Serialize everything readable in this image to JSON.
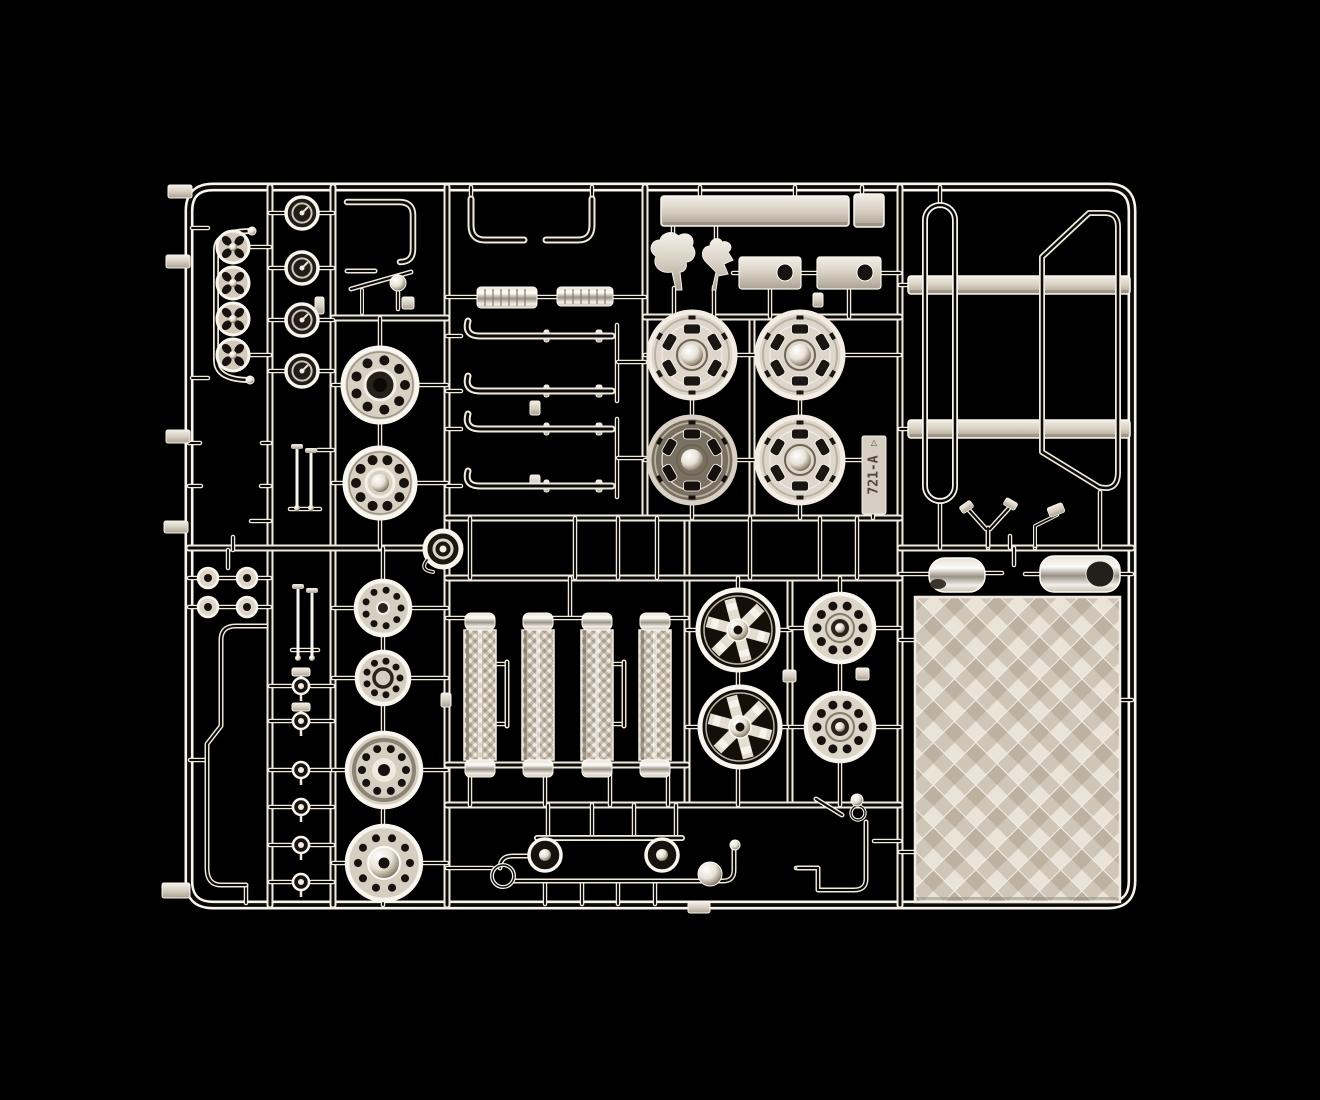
{
  "meta": {
    "title": "Chrome model kit sprue",
    "description": "Photograph of a chrome-plated plastic model kit parts sprue (runner tree) with wheels, exhaust pipes, air filters, mirrors, roll bars and a checker tread plate, on a black background",
    "tag_text": "721-A"
  },
  "palette": {
    "bg": "#000000",
    "hi": "#efe9df",
    "hi2": "#f8f5ef",
    "core": "#0d0b08",
    "plate": "#d9d1c4",
    "plate_dark": "#a89e8e",
    "dark_face": "#17120d",
    "tag_fill": "#d6cec2",
    "tag_text_color": "#4e443a"
  },
  "frame": {
    "d": "M213,187 H1108 Q1132,187 1132,211 V881 Q1132,905 1108,905 H213 Q189,905 189,881 V211 Q189,187 213,187 Z",
    "w": 9
  },
  "runners": [
    [
      270,
      187,
      270,
      905
    ],
    [
      333,
      187,
      333,
      905
    ],
    [
      447,
      187,
      447,
      905
    ],
    [
      645,
      187,
      645,
      518
    ],
    [
      687,
      518,
      687,
      805
    ],
    [
      752,
      317,
      752,
      518
    ],
    [
      790,
      578,
      790,
      805
    ],
    [
      900,
      187,
      900,
      905
    ],
    [
      189,
      548,
      447,
      548
    ],
    [
      447,
      518,
      900,
      518
    ],
    [
      447,
      578,
      900,
      578
    ],
    [
      900,
      548,
      1132,
      548
    ],
    [
      645,
      317,
      900,
      317
    ],
    [
      333,
      318,
      447,
      318
    ],
    [
      447,
      765,
      687,
      765
    ],
    [
      447,
      805,
      900,
      805
    ]
  ],
  "stubs": [
    [
      192,
      228,
      208,
      228
    ],
    [
      192,
      378,
      208,
      378
    ],
    [
      251,
      247,
      270,
      247
    ],
    [
      251,
      355,
      270,
      355
    ],
    [
      189,
      443,
      200,
      443
    ],
    [
      262,
      443,
      270,
      443
    ],
    [
      189,
      486,
      201,
      486
    ],
    [
      261,
      486,
      270,
      486
    ],
    [
      251,
      521,
      270,
      521
    ],
    [
      233,
      537,
      233,
      550
    ],
    [
      218,
      578,
      238,
      578
    ],
    [
      218,
      607,
      238,
      607
    ],
    [
      189,
      578,
      198,
      578
    ],
    [
      257,
      578,
      270,
      578
    ],
    [
      189,
      607,
      198,
      607
    ],
    [
      257,
      607,
      270,
      607
    ],
    [
      228,
      550,
      228,
      568
    ],
    [
      246,
      886,
      246,
      903
    ],
    [
      190,
      760,
      206,
      760
    ],
    [
      270,
      213,
      287,
      213
    ],
    [
      317,
      213,
      333,
      213
    ],
    [
      270,
      268,
      287,
      268
    ],
    [
      317,
      268,
      333,
      268
    ],
    [
      270,
      320,
      287,
      320
    ],
    [
      317,
      320,
      333,
      320
    ],
    [
      270,
      371,
      287,
      371
    ],
    [
      317,
      371,
      333,
      371
    ],
    [
      290,
      509,
      320,
      509
    ],
    [
      318,
      450,
      333,
      450
    ],
    [
      292,
      650,
      318,
      650
    ],
    [
      270,
      686,
      291,
      686
    ],
    [
      311,
      686,
      333,
      686
    ],
    [
      270,
      721,
      291,
      721
    ],
    [
      311,
      721,
      333,
      721
    ],
    [
      270,
      770,
      291,
      770
    ],
    [
      311,
      770,
      333,
      770
    ],
    [
      270,
      807,
      291,
      807
    ],
    [
      311,
      807,
      333,
      807
    ],
    [
      270,
      845,
      291,
      845
    ],
    [
      311,
      845,
      333,
      845
    ],
    [
      270,
      882,
      291,
      882
    ],
    [
      311,
      882,
      333,
      882
    ],
    [
      380,
      318,
      380,
      349
    ],
    [
      380,
      423,
      380,
      448
    ],
    [
      380,
      519,
      380,
      548
    ],
    [
      333,
      385,
      343,
      385
    ],
    [
      417,
      385,
      447,
      385
    ],
    [
      333,
      483,
      345,
      483
    ],
    [
      415,
      483,
      447,
      483
    ],
    [
      383,
      548,
      383,
      580
    ],
    [
      383,
      636,
      383,
      651
    ],
    [
      383,
      705,
      383,
      732
    ],
    [
      383,
      808,
      383,
      825
    ],
    [
      383,
      901,
      383,
      905
    ],
    [
      333,
      608,
      355,
      608
    ],
    [
      411,
      608,
      447,
      608
    ],
    [
      333,
      678,
      356,
      678
    ],
    [
      410,
      678,
      447,
      678
    ],
    [
      333,
      770,
      346,
      770
    ],
    [
      422,
      770,
      447,
      770
    ],
    [
      333,
      863,
      346,
      863
    ],
    [
      422,
      863,
      447,
      863
    ],
    [
      471,
      187,
      471,
      199
    ],
    [
      592,
      187,
      592,
      199
    ],
    [
      447,
      297,
      476,
      297
    ],
    [
      538,
      297,
      557,
      297
    ],
    [
      613,
      297,
      645,
      297
    ],
    [
      447,
      336,
      461,
      336
    ],
    [
      447,
      391,
      461,
      391
    ],
    [
      447,
      429,
      461,
      429
    ],
    [
      447,
      486,
      461,
      486
    ],
    [
      617,
      325,
      617,
      401
    ],
    [
      617,
      419,
      617,
      497
    ],
    [
      618,
      362,
      645,
      362
    ],
    [
      618,
      458,
      645,
      458
    ],
    [
      700,
      187,
      700,
      196
    ],
    [
      795,
      187,
      795,
      196
    ],
    [
      862,
      187,
      862,
      194
    ],
    [
      673,
      226,
      673,
      240
    ],
    [
      716,
      226,
      716,
      245
    ],
    [
      674,
      288,
      674,
      317
    ],
    [
      714,
      287,
      714,
      317
    ],
    [
      733,
      273,
      739,
      273
    ],
    [
      801,
      273,
      817,
      273
    ],
    [
      881,
      273,
      900,
      273
    ],
    [
      770,
      289,
      770,
      317
    ],
    [
      849,
      289,
      849,
      317
    ],
    [
      645,
      355,
      650,
      355
    ],
    [
      734,
      355,
      758,
      355
    ],
    [
      842,
      355,
      900,
      355
    ],
    [
      645,
      460,
      650,
      460
    ],
    [
      734,
      460,
      758,
      460
    ],
    [
      842,
      460,
      866,
      460
    ],
    [
      692,
      398,
      692,
      418
    ],
    [
      800,
      398,
      800,
      418
    ],
    [
      692,
      502,
      692,
      518
    ],
    [
      800,
      502,
      800,
      518
    ],
    [
      873,
      513,
      873,
      518
    ],
    [
      900,
      285,
      910,
      285
    ],
    [
      900,
      429,
      910,
      429
    ],
    [
      940,
      187,
      940,
      206
    ],
    [
      940,
      500,
      940,
      548
    ],
    [
      1100,
      492,
      1100,
      548
    ],
    [
      988,
      545,
      988,
      548
    ],
    [
      1035,
      545,
      1035,
      548
    ],
    [
      1010,
      536,
      1010,
      548
    ],
    [
      900,
      574,
      929,
      574
    ],
    [
      985,
      573,
      1002,
      573
    ],
    [
      1014,
      548,
      1014,
      565
    ],
    [
      1025,
      574,
      1040,
      574
    ],
    [
      1120,
      574,
      1132,
      574
    ],
    [
      900,
      640,
      915,
      640
    ],
    [
      900,
      852,
      915,
      852
    ],
    [
      1120,
      700,
      1132,
      700
    ],
    [
      470,
      518,
      470,
      578
    ],
    [
      575,
      518,
      575,
      578
    ],
    [
      618,
      518,
      618,
      578
    ],
    [
      657,
      518,
      657,
      578
    ],
    [
      750,
      518,
      750,
      578
    ],
    [
      820,
      518,
      820,
      578
    ],
    [
      857,
      518,
      857,
      578
    ],
    [
      447,
      618,
      464,
      618
    ],
    [
      671,
      618,
      687,
      618
    ],
    [
      570,
      578,
      570,
      616
    ],
    [
      538,
      618,
      597,
      618
    ],
    [
      496,
      664,
      507,
      664
    ],
    [
      496,
      724,
      507,
      724
    ],
    [
      613,
      664,
      624,
      664
    ],
    [
      613,
      724,
      624,
      724
    ],
    [
      470,
      765,
      470,
      805
    ],
    [
      545,
      765,
      545,
      805
    ],
    [
      610,
      765,
      610,
      805
    ],
    [
      668,
      765,
      668,
      805
    ],
    [
      687,
      630,
      700,
      630
    ],
    [
      776,
      630,
      790,
      630
    ],
    [
      687,
      727,
      702,
      727
    ],
    [
      778,
      727,
      790,
      727
    ],
    [
      790,
      628,
      808,
      628
    ],
    [
      872,
      628,
      900,
      628
    ],
    [
      790,
      727,
      808,
      727
    ],
    [
      872,
      727,
      900,
      727
    ],
    [
      738,
      578,
      738,
      592
    ],
    [
      840,
      578,
      840,
      596
    ],
    [
      738,
      668,
      738,
      689
    ],
    [
      840,
      660,
      840,
      695
    ],
    [
      738,
      765,
      738,
      805
    ],
    [
      840,
      759,
      840,
      805
    ],
    [
      548,
      805,
      548,
      837
    ],
    [
      592,
      805,
      592,
      837
    ],
    [
      634,
      805,
      634,
      837
    ],
    [
      676,
      805,
      676,
      837
    ],
    [
      545,
      881,
      545,
      904
    ],
    [
      582,
      881,
      582,
      904
    ],
    [
      618,
      881,
      618,
      904
    ],
    [
      655,
      881,
      655,
      904
    ],
    [
      447,
      868,
      492,
      868
    ],
    [
      874,
      841,
      900,
      841
    ],
    [
      796,
      868,
      816,
      868
    ],
    [
      398,
      291,
      398,
      309
    ]
  ],
  "tubes": [
    {
      "name": "handrail-part",
      "d": "M252,231 Q216,231 216,250 V360 Q216,380 250,380",
      "w": 6
    },
    {
      "name": "bent-pipe-part",
      "d": "M266,626 H236 Q221,626 221,640 V726 L207,744 V868 Q207,885 221,885 H246",
      "w": 5
    },
    {
      "name": "hook-pipe-part",
      "d": "M347,202 H399 Q413,202 413,215 V249 Q413,262 400,262",
      "w": 6.5
    },
    {
      "name": "short-pipe-part",
      "d": "M347,271 H375",
      "w": 5
    },
    {
      "name": "diagonal-rod-part",
      "d": "M351,289 L411,272",
      "w": 5
    },
    {
      "name": "post-part",
      "d": "M362,290 V313",
      "w": 4
    },
    {
      "name": "elbow-pipe-left",
      "d": "M471,199 V225 Q471,240 485,240 H524",
      "w": 7
    },
    {
      "name": "elbow-pipe-right",
      "d": "M592,199 V225 Q592,240 578,240 H546",
      "w": 7
    },
    {
      "name": "exhaust-pipe-1",
      "d": "M468,321 Q464,336 480,336 H612",
      "w": 7
    },
    {
      "name": "exhaust-pipe-2",
      "d": "M468,376 Q464,391 480,391 H612",
      "w": 7
    },
    {
      "name": "exhaust-pipe-3",
      "d": "M468,414 Q464,429 480,429 H612",
      "w": 7
    },
    {
      "name": "exhaust-pipe-4",
      "d": "M468,471 Q464,486 480,486 H612",
      "w": 7
    },
    {
      "name": "filter-handle-1",
      "d": "M507,662 V726",
      "w": 5
    },
    {
      "name": "filter-handle-2",
      "d": "M624,662 V726",
      "w": 5
    },
    {
      "name": "wishbone-part",
      "d": "M968,509 L986,529 M1011,506 L990,529 M988,528 V546",
      "w": 5
    },
    {
      "name": "mirror-arm-part",
      "d": "M1035,546 V526 L1057,515",
      "w": 4
    },
    {
      "name": "bracket-diagonal",
      "d": "M816,799 L842,815",
      "w": 5
    },
    {
      "name": "bracket-pipe-part",
      "d": "M866,822 V879 Q866,890 854,890 H818 V868 H798",
      "w": 5
    },
    {
      "name": "bell-bar-part",
      "d": "M537,838 H682",
      "w": 6
    },
    {
      "name": "curl-pipe-part",
      "d": "M531,856 H513 Q500,856 500,868",
      "w": 5
    },
    {
      "name": "long-low-pipe",
      "d": "M514,881 H723 Q734,881 734,870 V849",
      "w": 5
    },
    {
      "name": "hex-loop-part",
      "d": "M1042,452 V257 L1089,213 H1105 Q1118,213 1118,227 V472 Q1118,492 1099,487 Z",
      "w": 6
    }
  ],
  "loop_rect": {
    "x": 925,
    "y": 205,
    "w": 30,
    "h": 296,
    "rx": 15,
    "sw": 6
  },
  "panels": [
    {
      "name": "long-panel-part",
      "x": 661,
      "y": 196,
      "w": 188,
      "h": 30
    },
    {
      "name": "end-panel-part",
      "x": 854,
      "y": 194,
      "w": 30,
      "h": 33
    },
    {
      "name": "flat-bar-part-1",
      "x": 908,
      "y": 276,
      "w": 222,
      "h": 18
    },
    {
      "name": "flat-bar-part-2",
      "x": 908,
      "y": 420,
      "w": 222,
      "h": 18
    }
  ],
  "mufflers": [
    {
      "x": 477,
      "y": 287,
      "w": 60,
      "h": 21
    },
    {
      "x": 557,
      "y": 287,
      "w": 56,
      "h": 19
    }
  ],
  "slot_plates": [
    {
      "x": 739,
      "y": 257,
      "w": 62,
      "h": 32,
      "sx": 777,
      "sy": 264
    },
    {
      "x": 817,
      "y": 257,
      "w": 64,
      "h": 32,
      "sx": 857,
      "sy": 264
    }
  ],
  "silhouettes": [
    {
      "name": "poodle-silhouette-part",
      "d": "M676,290 L672,272 C660,274 652,266 656,256 C648,252 650,240 660,240 C662,232 674,230 678,236 C688,230 696,238 692,246 C698,252 694,262 686,262 C688,270 682,272 680,272 L682,290 Z"
    },
    {
      "name": "figure-silhouette-part",
      "d": "M712,290 L716,272 L706,262 C700,256 702,246 710,246 C710,238 720,236 722,242 C730,240 734,248 728,252 L733,260 L724,264 L728,274 L718,276 L716,290 Z"
    }
  ],
  "horns": {
    "cx": 233,
    "cys": [
      247,
      283,
      319,
      355
    ],
    "r": 16
  },
  "dials": {
    "cx": 302,
    "cys": [
      213,
      268,
      320,
      371
    ],
    "r": 16
  },
  "bulbs": [
    {
      "cx": 208,
      "cy": 578
    },
    {
      "cx": 247,
      "cy": 578
    },
    {
      "cx": 208,
      "cy": 607
    },
    {
      "cx": 247,
      "cy": 607
    }
  ],
  "valves": {
    "cx": 301,
    "items": [
      {
        "cy": 686,
        "box": true
      },
      {
        "cy": 721,
        "box": true
      },
      {
        "cy": 770
      },
      {
        "cy": 807
      },
      {
        "cy": 845
      },
      {
        "cy": 882
      }
    ]
  },
  "pins": [
    {
      "x": 297,
      "y1": 448,
      "y2": 508
    },
    {
      "x": 311,
      "y1": 452,
      "y2": 508
    },
    {
      "x": 298,
      "y1": 588,
      "y2": 658
    },
    {
      "x": 312,
      "y1": 592,
      "y2": 658
    }
  ],
  "hubs": [
    {
      "cx": 380,
      "cy": 385,
      "r": 37,
      "holes": 9,
      "hr": 25,
      "center": "dark"
    },
    {
      "cx": 380,
      "cy": 483,
      "r": 35,
      "holes": 10,
      "hr": 24,
      "center": "dome"
    }
  ],
  "drums": [
    {
      "cx": 383,
      "cy": 608,
      "r": 27,
      "holes": 9,
      "hr": 18,
      "style": "flat"
    },
    {
      "cx": 383,
      "cy": 678,
      "r": 26,
      "holes": 9,
      "hr": 17,
      "style": "flat2"
    },
    {
      "cx": 384,
      "cy": 770,
      "r": 37,
      "holes": 10,
      "hr": 22,
      "style": "deep"
    },
    {
      "cx": 384,
      "cy": 863,
      "r": 37,
      "holes": 10,
      "hr": 26,
      "style": "hubcap"
    }
  ],
  "wheels_fancy": {
    "r": 43,
    "items": [
      {
        "cx": 692,
        "cy": 355
      },
      {
        "cx": 800,
        "cy": 355
      },
      {
        "cx": 692,
        "cy": 460,
        "dark": true
      },
      {
        "cx": 800,
        "cy": 460
      }
    ]
  },
  "wheels_spoked": {
    "r": 40,
    "items": [
      {
        "cx": 738,
        "cy": 630
      },
      {
        "cx": 740,
        "cy": 727
      }
    ]
  },
  "wheels_drum": {
    "r": 34,
    "items": [
      {
        "cx": 840,
        "cy": 628
      },
      {
        "cx": 840,
        "cy": 727
      }
    ]
  },
  "cylinders": {
    "cxs": [
      480,
      538,
      597,
      655
    ],
    "top": 613,
    "cap_h": 17,
    "body_h": 130,
    "w": 32
  },
  "capsules": [
    {
      "name": "mirror-housing-1",
      "x": 929,
      "y": 558,
      "w": 56,
      "h": 34,
      "rx": 16,
      "dark": "left"
    },
    {
      "name": "mirror-housing-2",
      "x": 1040,
      "y": 556,
      "w": 80,
      "h": 36,
      "rx": 14,
      "dark": "right"
    }
  ],
  "checker_plate": {
    "x": 915,
    "y": 597,
    "w": 205,
    "h": 305
  },
  "tag": {
    "x": 862,
    "y": 436,
    "w": 24,
    "h": 78
  },
  "snail": {
    "cx": 443,
    "cy": 549,
    "r": 18
  },
  "spheres": [
    {
      "cx": 710,
      "cy": 874,
      "r": 12
    },
    {
      "cx": 398,
      "cy": 283,
      "r": 8
    },
    {
      "cx": 735,
      "cy": 845,
      "r": 5
    },
    {
      "cx": 252,
      "cy": 231,
      "r": 4
    },
    {
      "cx": 250,
      "cy": 380,
      "r": 4
    },
    {
      "cx": 857,
      "cy": 800,
      "r": 6
    }
  ],
  "bells": [
    {
      "cx": 545,
      "cy": 855,
      "r": 16
    },
    {
      "cx": 662,
      "cy": 855,
      "r": 16
    }
  ],
  "rings": [
    {
      "cx": 503,
      "cy": 876,
      "r": 11,
      "w": 4
    },
    {
      "cx": 858,
      "cy": 813,
      "r": 7,
      "w": 3.5
    }
  ],
  "tabs": [
    {
      "x": 168,
      "y": 185,
      "w": 24,
      "h": 13
    },
    {
      "x": 166,
      "y": 255,
      "w": 24,
      "h": 13
    },
    {
      "x": 166,
      "y": 430,
      "w": 24,
      "h": 13
    },
    {
      "x": 164,
      "y": 521,
      "w": 24,
      "h": 12
    },
    {
      "x": 162,
      "y": 883,
      "w": 28,
      "h": 15
    },
    {
      "x": 688,
      "y": 902,
      "w": 22,
      "h": 11
    }
  ],
  "nubs": [
    {
      "x": 315,
      "y": 297,
      "w": 9,
      "h": 17
    },
    {
      "x": 441,
      "y": 693,
      "w": 10,
      "h": 14
    },
    {
      "x": 530,
      "y": 401,
      "w": 10,
      "h": 14
    },
    {
      "x": 530,
      "y": 475,
      "w": 10,
      "h": 14
    },
    {
      "x": 783,
      "y": 670,
      "w": 13,
      "h": 12
    },
    {
      "x": 856,
      "y": 668,
      "w": 13,
      "h": 12
    },
    {
      "x": 813,
      "y": 293,
      "w": 10,
      "h": 14
    },
    {
      "x": 402,
      "y": 297,
      "w": 12,
      "h": 12
    },
    {
      "x": 596,
      "y": 330,
      "w": 6,
      "h": 12
    },
    {
      "x": 544,
      "y": 330,
      "w": 5,
      "h": 12
    },
    {
      "x": 596,
      "y": 385,
      "w": 6,
      "h": 12
    },
    {
      "x": 544,
      "y": 385,
      "w": 5,
      "h": 12
    },
    {
      "x": 596,
      "y": 423,
      "w": 6,
      "h": 12
    },
    {
      "x": 544,
      "y": 423,
      "w": 5,
      "h": 12
    },
    {
      "x": 596,
      "y": 480,
      "w": 6,
      "h": 12
    },
    {
      "x": 544,
      "y": 480,
      "w": 5,
      "h": 12
    }
  ],
  "pads": [
    {
      "x": 960,
      "y": 503,
      "w": 13,
      "h": 8,
      "rot": -35
    },
    {
      "x": 1004,
      "y": 500,
      "w": 13,
      "h": 8,
      "rot": 30
    },
    {
      "x": 1048,
      "y": 505,
      "w": 16,
      "h": 10,
      "rot": -22
    }
  ]
}
